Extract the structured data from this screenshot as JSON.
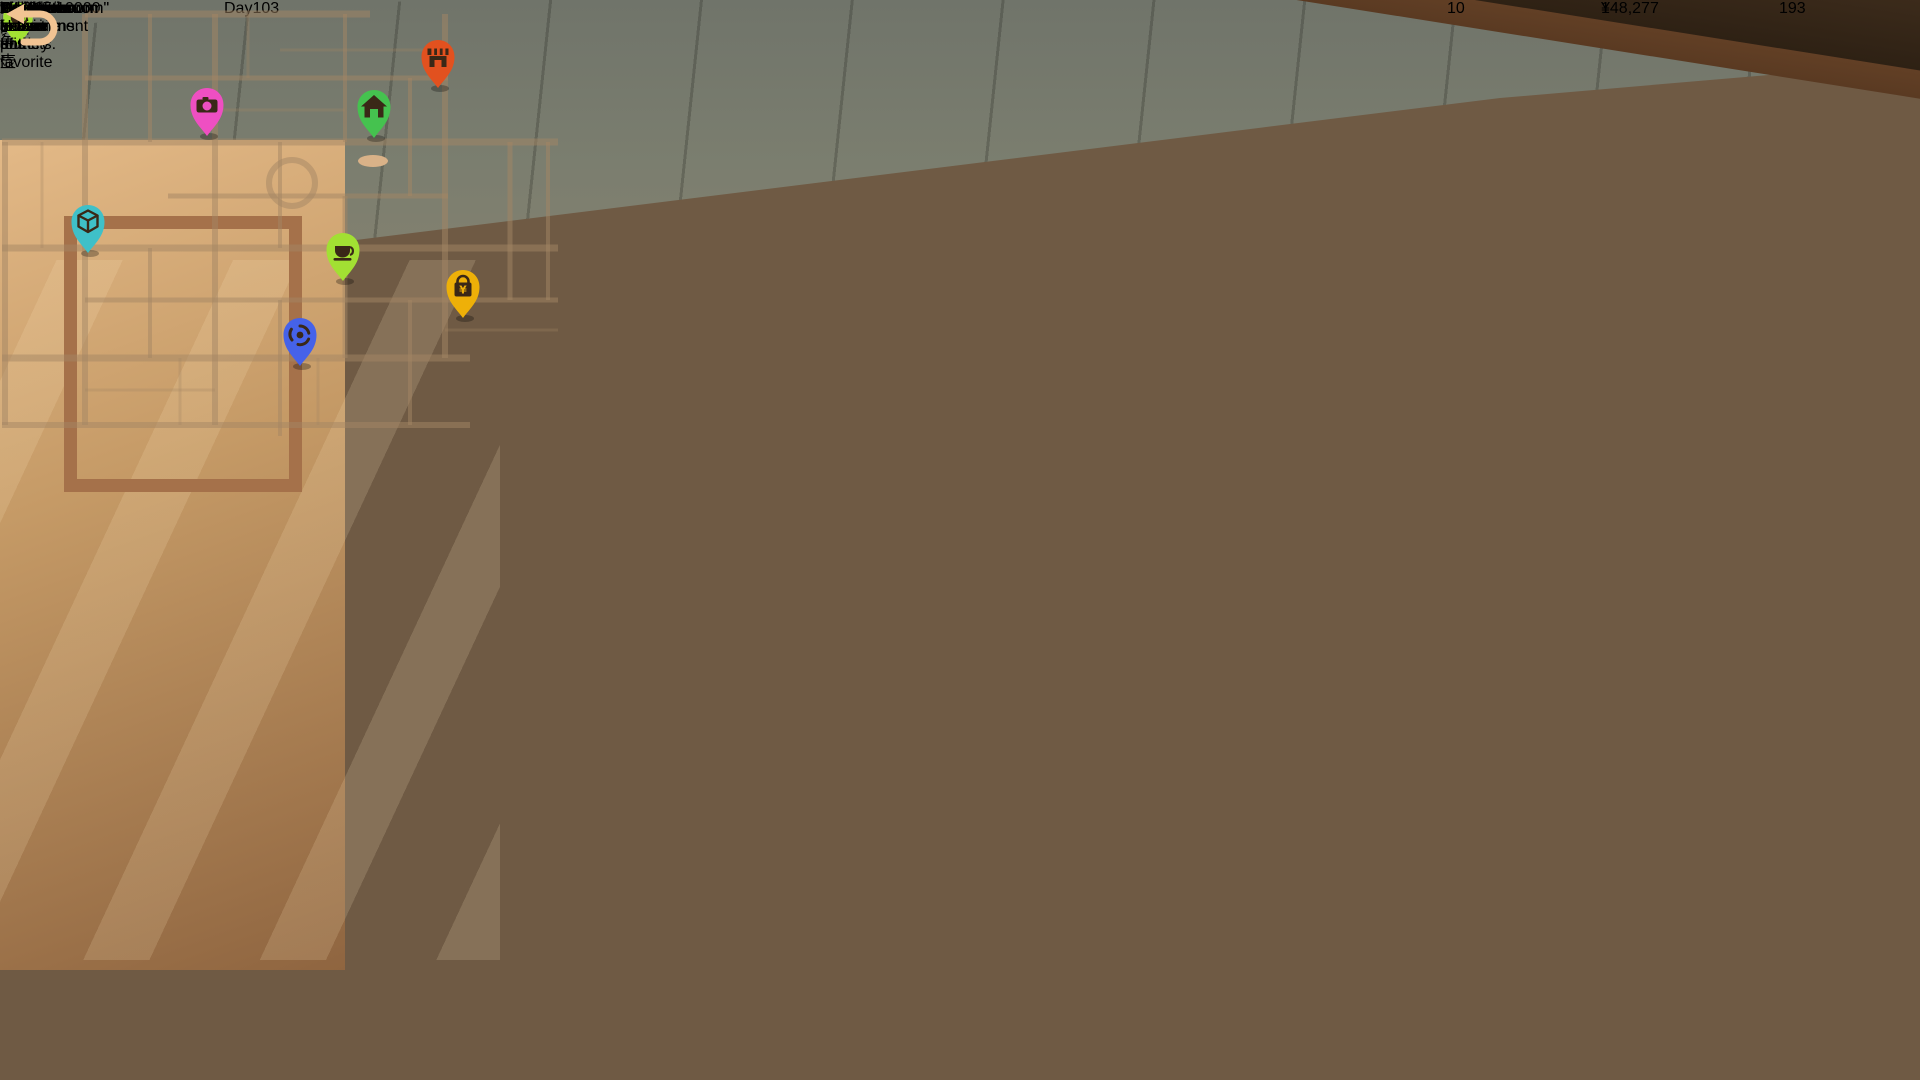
{
  "hud": {
    "xp": {
      "level": "9",
      "progress": "1467/10000"
    },
    "day": "Day103",
    "location_title": "Showroom",
    "resources": {
      "inspiration": "10",
      "money": "148,277",
      "materials": "193"
    },
    "coin_symbol": "¥"
  },
  "scene": {
    "plaque_text": "哥窑壶"
  },
  "map_panel": {
    "header": "Map",
    "area_title": "Pottery Town",
    "area_subtitle": "Active area",
    "locations": [
      {
        "id": "myshowroom",
        "label": "MyShowroom",
        "color": "#45c24f",
        "glyph": "house",
        "map_x": 374,
        "map_y": 107
      },
      {
        "id": "store",
        "label": "Store",
        "color": "#eeb008",
        "glyph": "bag",
        "map_x": 463,
        "map_y": 287
      },
      {
        "id": "pottery-shop",
        "label": "Pottery shop",
        "color": "#e2511f",
        "glyph": "shop",
        "map_x": 438,
        "map_y": 57
      },
      {
        "id": "decoration-shop",
        "label": "Decoration shop",
        "color": "#3fc0c8",
        "glyph": "box",
        "map_x": 88,
        "map_y": 222
      },
      {
        "id": "photo-studio",
        "label": "Photo Studio",
        "color": "#ee4fc2",
        "glyph": "camera",
        "map_x": 207,
        "map_y": 105
      },
      {
        "id": "time-machine",
        "label": "Time Machine",
        "color": "#4562e9",
        "glyph": "spiral",
        "map_x": 300,
        "map_y": 335
      },
      {
        "id": "tea-house",
        "label": "Tea House",
        "color": "#a2e033",
        "glyph": "cup",
        "map_x": 343,
        "map_y": 250
      }
    ],
    "player_marker": {
      "map_x": 373,
      "map_y": 161
    },
    "info": {
      "title": "MyShowroom",
      "description_lines": [
        "\"MyShowroom\" is a",
        "well-known pottery",
        "exhibition hall.",
        "\"MyShowroom\" has a",
        "beautiful environment and",
        "numerous collections. It is",
        "rated as one of the favorite",
        "attractions for tourists."
      ]
    }
  },
  "icons": {
    "xp-level-badge": "gold circle with level number",
    "calendar-icon": "red-top calendar",
    "bulb-icon": "lightbulb (inspiration)",
    "coin-icon": "gold coin with yen sign",
    "cube-icon": "orange material cube",
    "map-pin-icon": "teardrop location pin",
    "player-marker-icon": "beige ellipse",
    "return-arrow-icon": "curved back arrow"
  }
}
